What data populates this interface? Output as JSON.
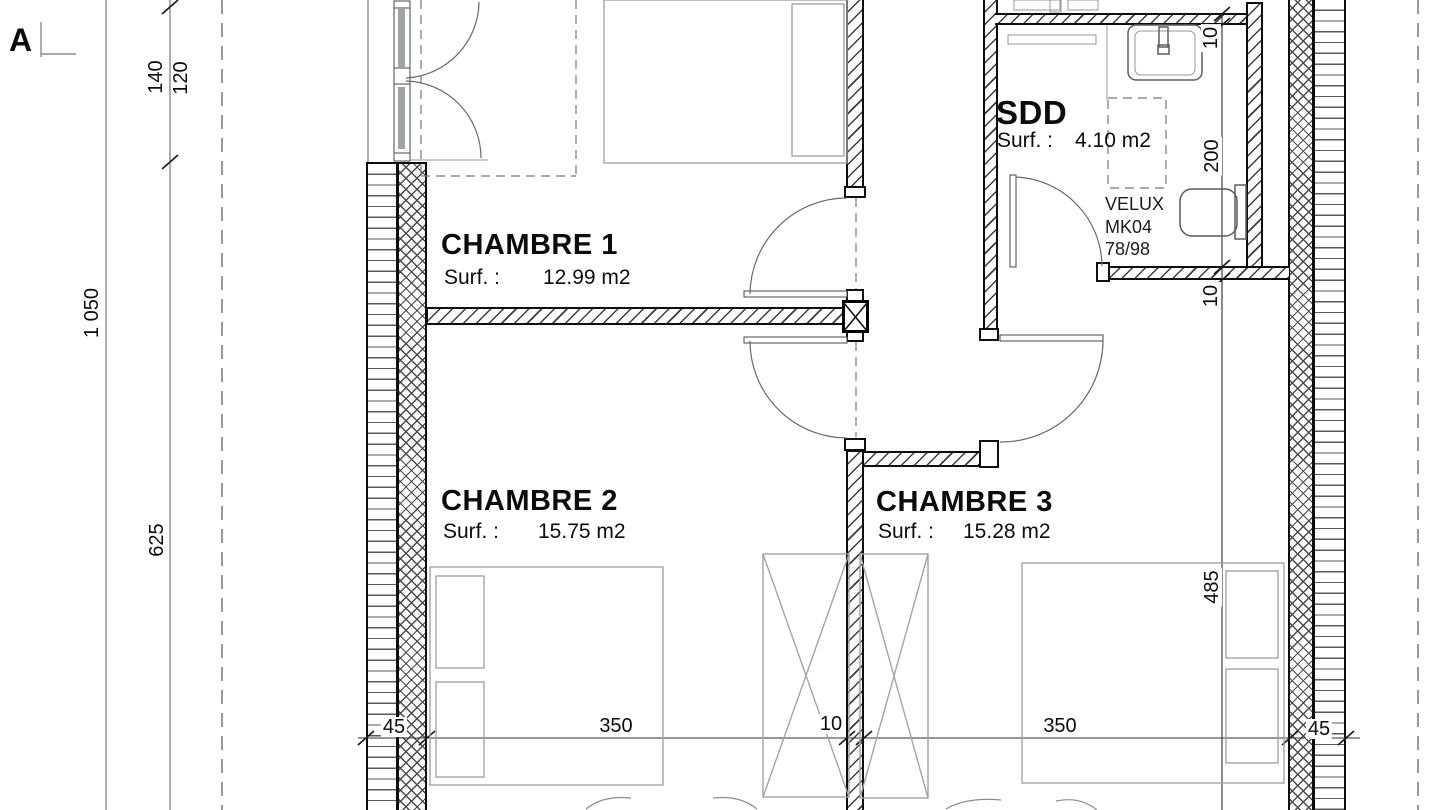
{
  "marker": {
    "label": "A"
  },
  "rooms": {
    "chambre1": {
      "name": "CHAMBRE 1",
      "surface_label": "Surf. :",
      "surface": "12.99 m2"
    },
    "chambre2": {
      "name": "CHAMBRE 2",
      "surface_label": "Surf. :",
      "surface": "15.75 m2"
    },
    "chambre3": {
      "name": "CHAMBRE 3",
      "surface_label": "Surf. :",
      "surface": "15.28 m2"
    },
    "sdd": {
      "name": "SDD",
      "surface_label": "Surf. :",
      "surface": "4.10 m2"
    }
  },
  "velux": {
    "line1": "VELUX",
    "line2": "MK04",
    "line3": "78/98"
  },
  "dims": {
    "left": {
      "seg140": "140",
      "seg120": "120",
      "total": "1 050",
      "seg625": "625"
    },
    "right": {
      "wall_top": "10",
      "sdd_depth": "200",
      "wall_bottom": "10",
      "room_depth": "485"
    },
    "bottom": {
      "left_wall": "45",
      "room2_width": "350",
      "partition": "10",
      "room3_width": "350",
      "right_wall": "45"
    }
  },
  "colors": {
    "wall_line": "#0d0d0d",
    "hatch": "#4a4a4a",
    "furniture": "#a4a4a4",
    "text": "#0c0c0c",
    "background": "#ffffff"
  }
}
